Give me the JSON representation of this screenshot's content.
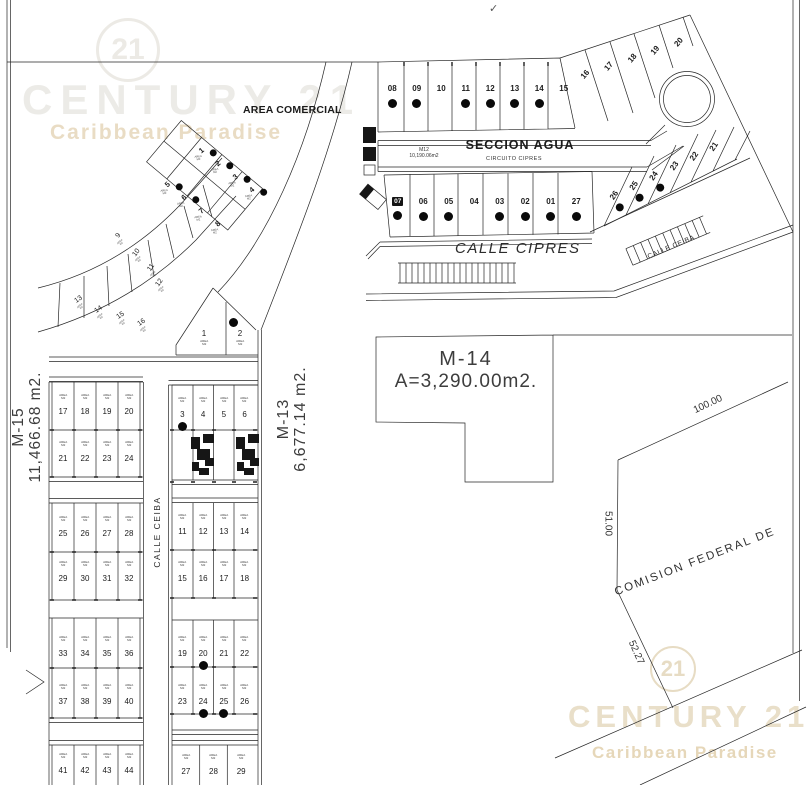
{
  "page": {
    "checkmark": "✓"
  },
  "watermarks": {
    "top": {
      "logo": "21",
      "brand": "CENTURY 21",
      "tagline": "Caribbean Paradise"
    },
    "bottom": {
      "logo": "21",
      "brand": "CENTURY 21",
      "tagline": "Caribbean Paradise"
    }
  },
  "labels": {
    "area_comercial": "AREA COMERCIAL",
    "seccion_agua": "SECCION AGUA",
    "m12_name": "M12",
    "m12_area": "10,190.06m2",
    "circuito_cipres": "CIRCUITO CIPRES",
    "calle_cipres": "CALLE CIPRES",
    "calle_ceiba_right": "CALLE CEIBA",
    "calle_ceiba_left": "CALLE CEIBA",
    "m14_name": "M-14",
    "m14_area": "A=3,290.00m2.",
    "m13_name": "M-13",
    "m13_area": "6,677.14 m2.",
    "m15_name": "M-15",
    "m15_area": "11,466.68 m2.",
    "cfe": "COMISION FEDERAL DE",
    "dim_top": "100.00",
    "dim_left": "51.00",
    "dim_bottom": "52.27"
  },
  "lot_area_caption": "AREA",
  "lot_area_unit": "M2",
  "lots": {
    "m12_top": [
      {
        "n": "08",
        "dot": true
      },
      {
        "n": "09",
        "dot": true
      },
      {
        "n": "10"
      },
      {
        "n": "11",
        "dot": true
      },
      {
        "n": "12",
        "dot": true
      },
      {
        "n": "13",
        "dot": true
      },
      {
        "n": "14",
        "dot": true
      },
      {
        "n": "15"
      }
    ],
    "m12_slant_top": [
      {
        "n": "16"
      },
      {
        "n": "17"
      },
      {
        "n": "18"
      },
      {
        "n": "19"
      },
      {
        "n": "20"
      }
    ],
    "m12_bottom": [
      {
        "n": "07",
        "dot": true,
        "badge": true
      },
      {
        "n": "06",
        "dot": true
      },
      {
        "n": "05",
        "dot": true
      },
      {
        "n": "04"
      },
      {
        "n": "03",
        "dot": true
      },
      {
        "n": "02",
        "dot": true
      },
      {
        "n": "01",
        "dot": true
      },
      {
        "n": "27",
        "dot": true
      }
    ],
    "m12_slant_bottom": [
      {
        "n": "26",
        "dot": true
      },
      {
        "n": "25",
        "dot": true
      },
      {
        "n": "24",
        "dot": true
      },
      {
        "n": "23"
      },
      {
        "n": "22"
      },
      {
        "n": "21"
      }
    ],
    "m15_diag_upper": [
      {
        "n": "1",
        "dot": true
      },
      {
        "n": "2",
        "dot": true
      },
      {
        "n": "3",
        "dot": true
      },
      {
        "n": "4",
        "dot": true
      }
    ],
    "m15_diag_lower": [
      {
        "n": "5",
        "dot": true
      },
      {
        "n": "6",
        "dot": true
      },
      {
        "n": "7"
      },
      {
        "n": "8"
      }
    ],
    "m15_fan_upper": [
      {
        "n": "9"
      },
      {
        "n": "10"
      },
      {
        "n": "11"
      },
      {
        "n": "12"
      }
    ],
    "m15_fan_lower": [
      {
        "n": "13"
      },
      {
        "n": "14"
      },
      {
        "n": "15"
      },
      {
        "n": "16"
      }
    ],
    "m15_grid": [
      [
        {
          "n": "17"
        },
        {
          "n": "18"
        },
        {
          "n": "19"
        },
        {
          "n": "20"
        }
      ],
      [
        {
          "n": "21"
        },
        {
          "n": "22"
        },
        {
          "n": "23"
        },
        {
          "n": "24"
        }
      ],
      [
        {
          "n": "25"
        },
        {
          "n": "26"
        },
        {
          "n": "27"
        },
        {
          "n": "28"
        }
      ],
      [
        {
          "n": "29"
        },
        {
          "n": "30"
        },
        {
          "n": "31"
        },
        {
          "n": "32"
        }
      ],
      [
        {
          "n": "33"
        },
        {
          "n": "34"
        },
        {
          "n": "35"
        },
        {
          "n": "36"
        }
      ],
      [
        {
          "n": "37"
        },
        {
          "n": "38"
        },
        {
          "n": "39"
        },
        {
          "n": "40"
        }
      ],
      [
        {
          "n": "41"
        },
        {
          "n": "42"
        },
        {
          "n": "43"
        },
        {
          "n": "44"
        }
      ]
    ],
    "m13_peak": [
      {
        "n": "1"
      },
      {
        "n": "2",
        "dot": true
      }
    ],
    "m13_grid": [
      [
        {
          "n": "3",
          "dot": true
        },
        {
          "n": "4"
        },
        {
          "n": "5"
        },
        {
          "n": "6"
        }
      ],
      [
        {
          "n": "11"
        },
        {
          "n": "12"
        },
        {
          "n": "13"
        },
        {
          "n": "14"
        }
      ],
      [
        {
          "n": "15"
        },
        {
          "n": "16"
        },
        {
          "n": "17"
        },
        {
          "n": "18"
        }
      ],
      [
        {
          "n": "19"
        },
        {
          "n": "20",
          "dot": true
        },
        {
          "n": "21"
        },
        {
          "n": "22"
        }
      ],
      [
        {
          "n": "23"
        },
        {
          "n": "24",
          "dot": true
        },
        {
          "n": "25",
          "dot": true
        },
        {
          "n": "26"
        }
      ],
      [
        {
          "n": "27"
        },
        {
          "n": "28"
        },
        {
          "n": "29"
        }
      ]
    ]
  }
}
